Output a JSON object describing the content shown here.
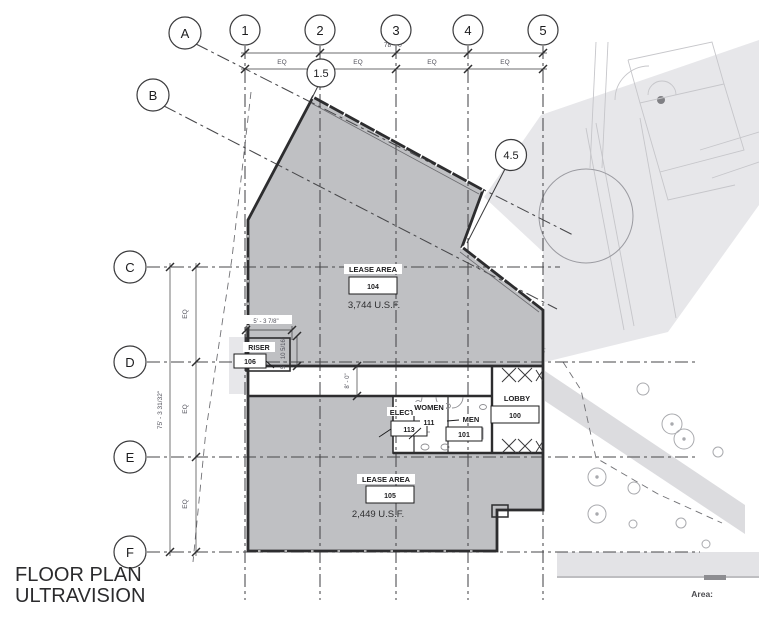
{
  "drawing": {
    "title_line1": "FLOOR PLAN",
    "title_line2": "ULTRAVISION",
    "area_label": "Area:"
  },
  "grid": {
    "columns": [
      "1",
      "2",
      "3",
      "4",
      "5"
    ],
    "column_intermediates": {
      "c15": "1.5",
      "c45": "4.5"
    },
    "rows": [
      "C",
      "D",
      "E",
      "F"
    ],
    "diagonals": [
      "A",
      "B"
    ]
  },
  "dimensions": {
    "top_total": "78' - 0\"",
    "top_eq": [
      "EQ",
      "EQ",
      "EQ",
      "EQ"
    ],
    "left_total": "75' - 3 31/32\"",
    "left_eq": [
      "EQ",
      "EQ",
      "EQ"
    ],
    "riser_width": "5' - 3 7/8\"",
    "riser_height": "5' - 10 5/16\"",
    "corridor_height": "8' - 0\""
  },
  "rooms": {
    "lease104": {
      "name": "LEASE AREA",
      "number": "104",
      "area": "3,744 U.S.F."
    },
    "lease105": {
      "name": "LEASE AREA",
      "number": "105",
      "area": "2,449 U.S.F."
    },
    "riser": {
      "name": "RISER",
      "number": "106"
    },
    "elect": {
      "name": "ELECT",
      "number": "113"
    },
    "women": {
      "name": "WOMEN",
      "number": "111"
    },
    "men": {
      "name": "MEN",
      "number": "101"
    },
    "lobby": {
      "name": "LOBBY",
      "number": "100"
    }
  },
  "colors": {
    "lease_fill": "#bfc0c3",
    "context_fill": "#e7e7ea",
    "walkway_fill": "#dcdcdf",
    "wall_line": "#2d2d2f",
    "grid_line": "#47474a",
    "text_dark": "#1c1c1e",
    "text_dim": "#50505a"
  }
}
